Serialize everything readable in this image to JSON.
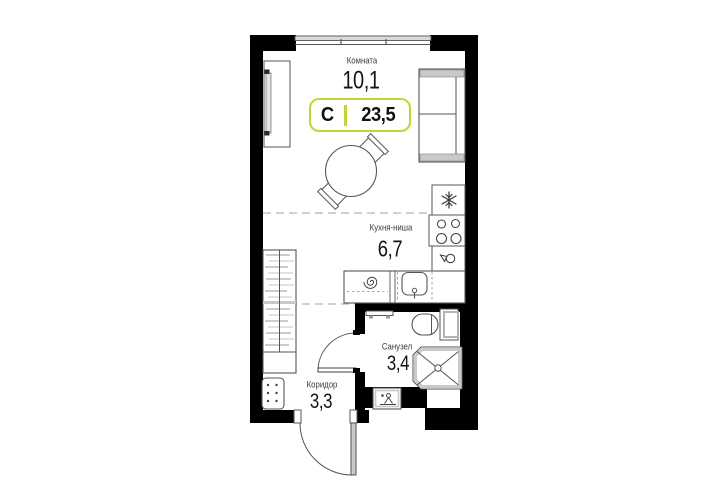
{
  "plan": {
    "badge": {
      "type_label": "С",
      "total_area": "23,5"
    },
    "rooms": [
      {
        "name": "Комната",
        "area": "10,1"
      },
      {
        "name": "Кухня-ниша",
        "area": "6,7"
      },
      {
        "name": "Санузел",
        "area": "3,4"
      },
      {
        "name": "Коридор",
        "area": "3,3"
      }
    ],
    "icons": {
      "fridge": "snowflake-icon",
      "stove": "burners-icon",
      "kitchen_sink": "sink-icon",
      "hob": "spiral-icon",
      "shower": "shower-cross-icon",
      "washbasin": "tap-icon"
    }
  },
  "colors": {
    "accent": "#c5d333",
    "wall": "#000000",
    "line": "#4d4d4d",
    "gray": "#c9c9c9",
    "dash": "#b3b3b3"
  }
}
